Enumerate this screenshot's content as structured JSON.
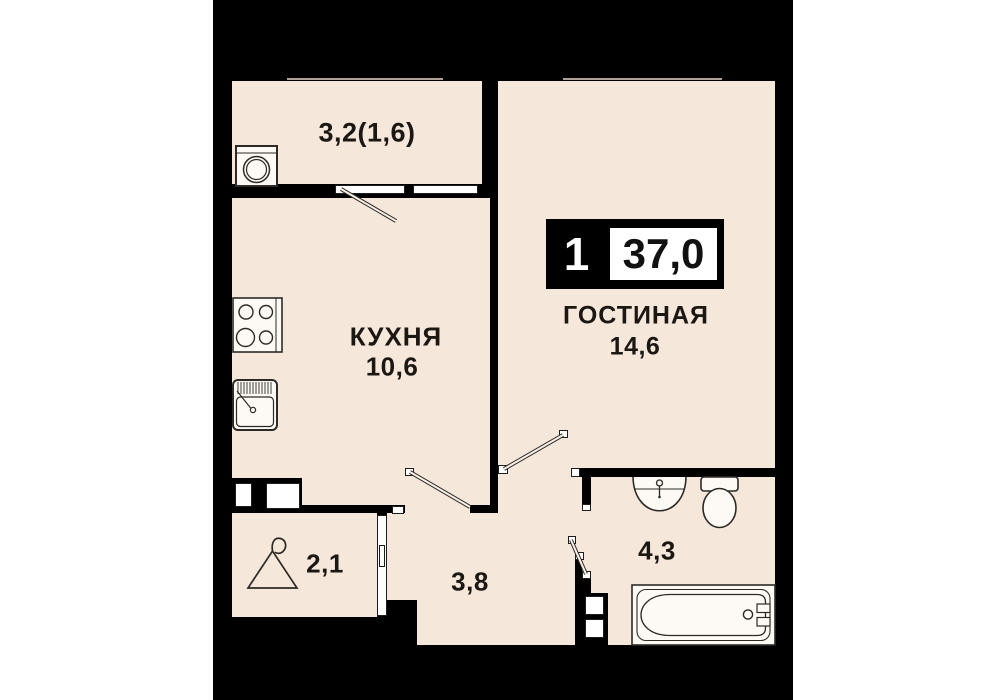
{
  "plan_title": "apartment-floor-plan",
  "badge": {
    "rooms_count": "1",
    "total_area": "37,0"
  },
  "rooms": {
    "balcony": {
      "label": "3,2(1,6)"
    },
    "kitchen": {
      "name": "КУХНЯ",
      "area": "10,6"
    },
    "living": {
      "name": "ГОСТИНАЯ",
      "area": "14,6"
    },
    "hallway": {
      "area": "2,1"
    },
    "corridor": {
      "area": "3,8"
    },
    "bathroom": {
      "area": "4,3"
    }
  },
  "icons": [
    "washing-machine-icon",
    "stove-icon",
    "kitchen-sink-icon",
    "hanger-icon",
    "washbasin-icon",
    "toilet-icon",
    "bathtub-icon",
    "door-swing-icon",
    "window-icon"
  ],
  "colors": {
    "page": "#ffffff",
    "wall": "#000000",
    "floor": "#f6e7db",
    "fixture_fill": "#fdf9f4",
    "line": "#2d2a26"
  }
}
